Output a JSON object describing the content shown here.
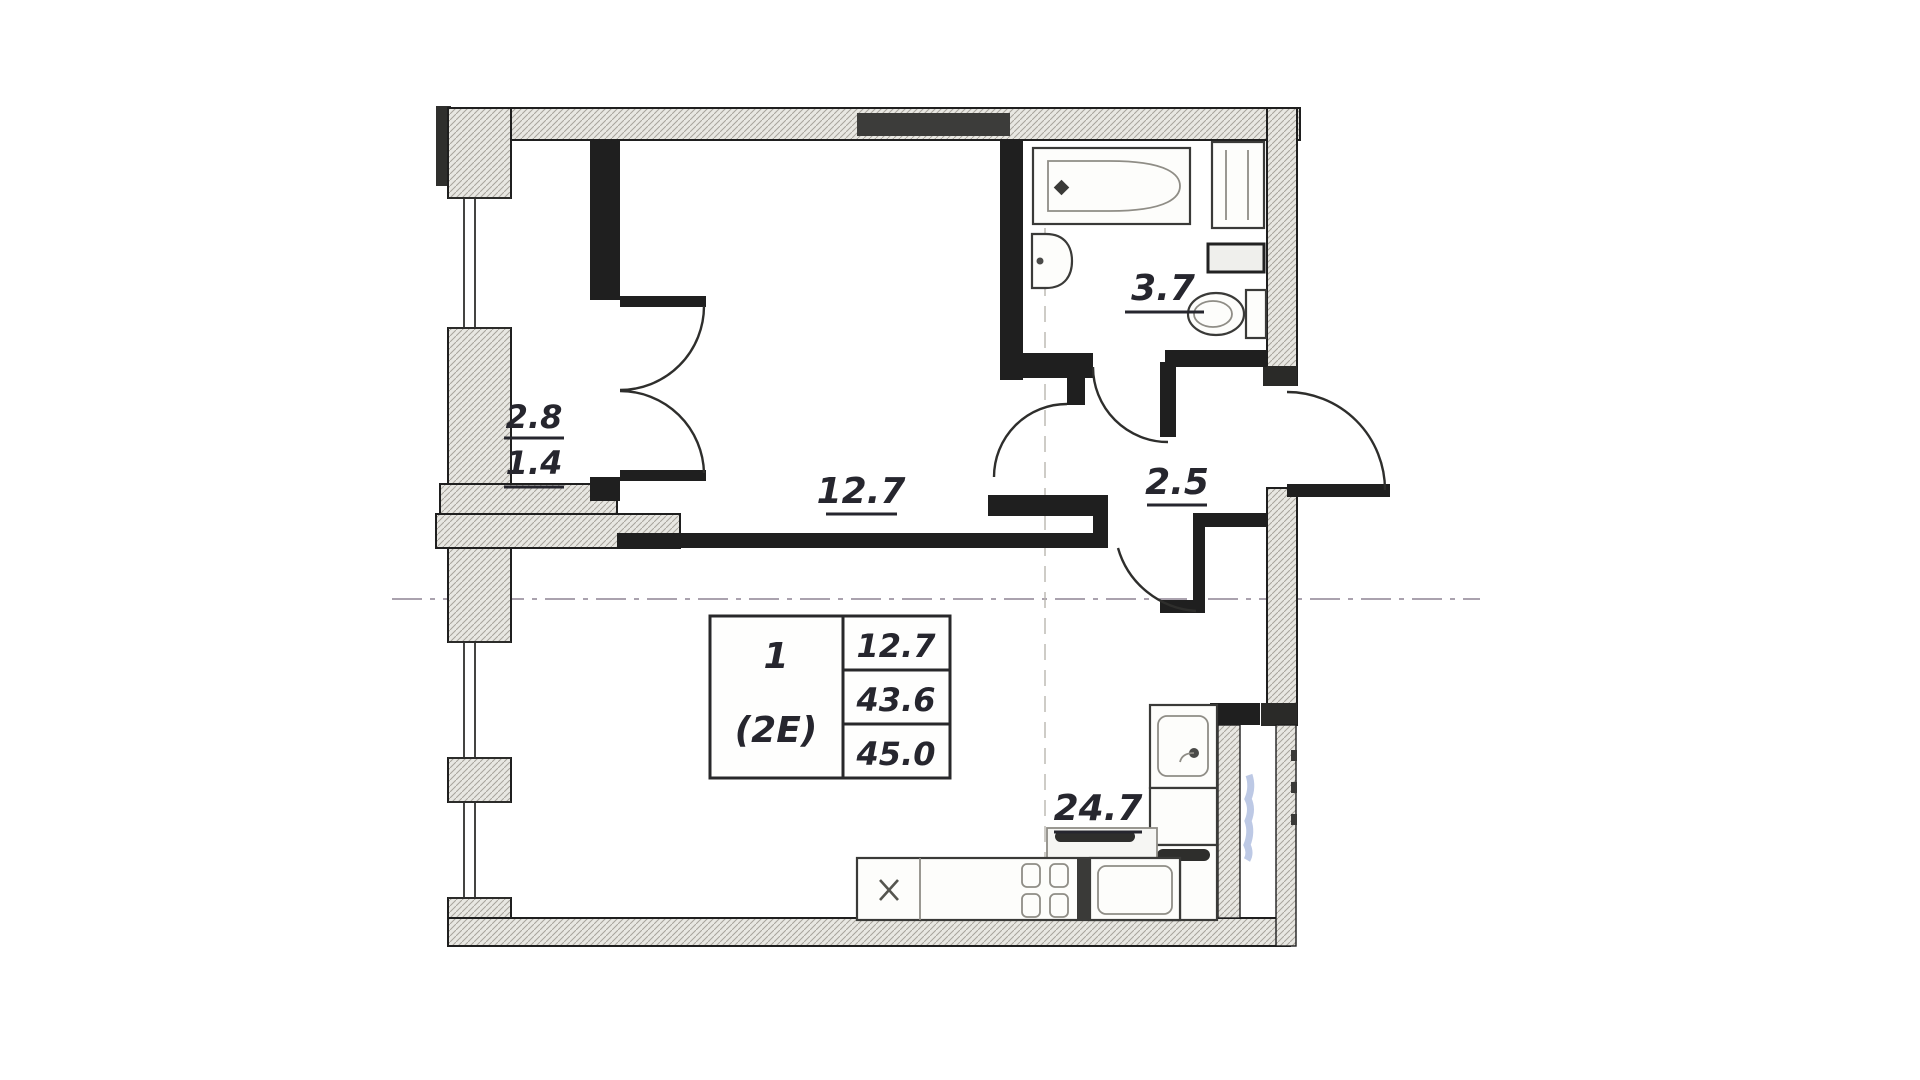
{
  "document": {
    "type": "apartment-floor-plan"
  },
  "rooms": {
    "loggia": {
      "area_full": "2.8",
      "area_reduced": "1.4"
    },
    "main_room": {
      "area": "12.7"
    },
    "bathroom": {
      "area": "3.7"
    },
    "hallway": {
      "area": "2.5"
    },
    "living_kitchen": {
      "area": "24.7"
    }
  },
  "stamp": {
    "apartment_number": "1",
    "apartment_type": "(2E)",
    "values": [
      "12.7",
      "43.6",
      "45.0"
    ]
  },
  "fixture_icons": [
    "bathtub-icon",
    "washbasin-icon",
    "toilet-icon",
    "washing-machine-icon",
    "storage-box-icon",
    "kitchen-sink-icon",
    "stove-icon",
    "refrigerator-icon",
    "kitchen-counter-icon",
    "door-swing-icon",
    "illegible-blue-note-icon"
  ],
  "colors": {
    "wall": "#1f1f1f",
    "hatch_fill": "#e8e7e2",
    "hatch_line": "#a7a49c",
    "label": "#26262e",
    "dash": "#8d8494",
    "blue": "#6d88c6",
    "paper": "#ffffff"
  }
}
